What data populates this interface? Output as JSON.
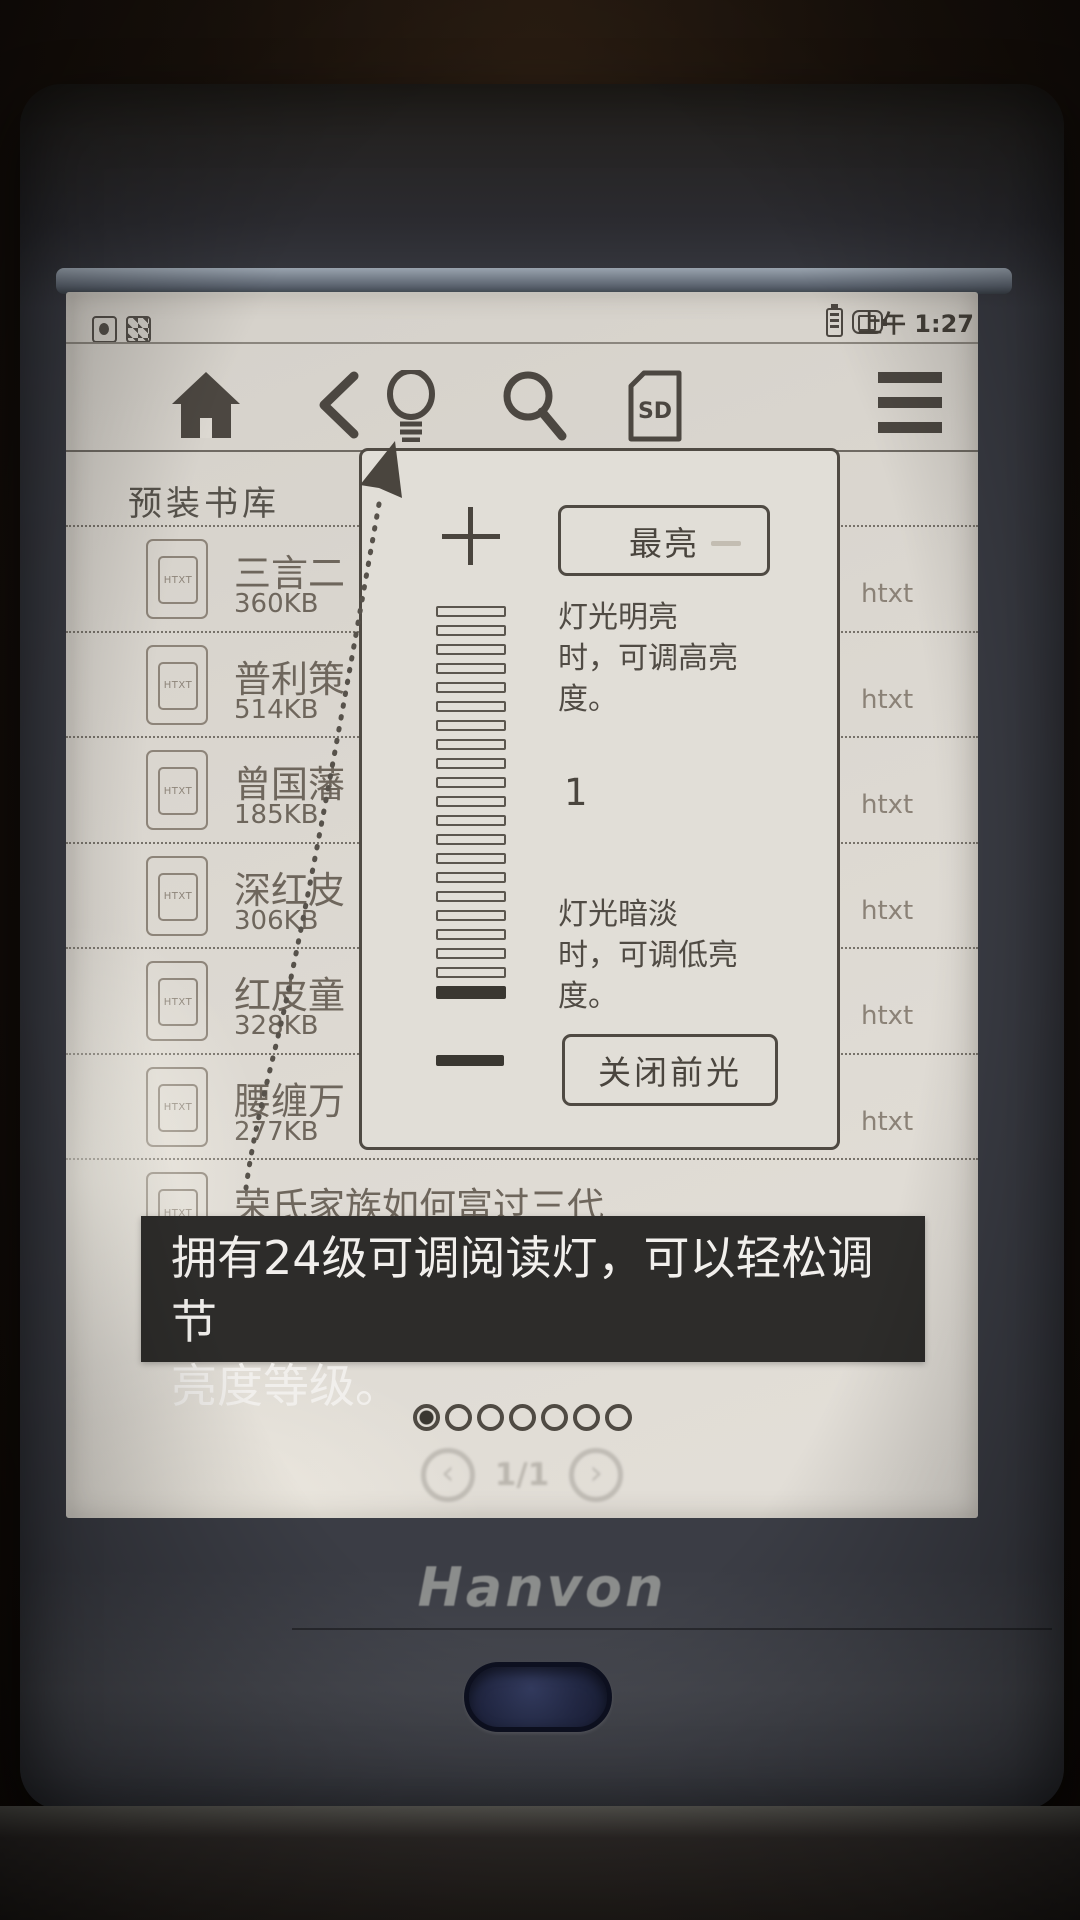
{
  "device": {
    "brand_logo": "Hanvon"
  },
  "status_bar": {
    "time": "上午 1:27",
    "left_icon_names": [
      "storage-icon",
      "sd-card-status-icon"
    ],
    "right_icon_names": [
      "battery-icon",
      "battery-charge-icon"
    ]
  },
  "toolbar": {
    "icon_names": [
      "home-icon",
      "back-icon",
      "frontlight-icon",
      "search-icon",
      "sd-card-icon",
      "menu-icon"
    ],
    "sd_label": "SD"
  },
  "library": {
    "title": "预装书库",
    "book_icon_label": "HTXT",
    "books": [
      {
        "title": "三言二",
        "size": "360KB",
        "format": "htxt"
      },
      {
        "title": "普利策",
        "size": "514KB",
        "format": "htxt"
      },
      {
        "title": "曾国藩",
        "size": "185KB",
        "format": "htxt"
      },
      {
        "title": "深红皮",
        "size": "306KB",
        "format": "htxt"
      },
      {
        "title": "红皮童",
        "size": "328KB",
        "format": "htxt"
      },
      {
        "title": "腰缠万",
        "size": "277KB",
        "format": "htxt"
      },
      {
        "title": "荣氏家族如何富过三代",
        "size": "",
        "format": ""
      }
    ]
  },
  "brightness_popup": {
    "max_button": "最亮",
    "desc_high": "灯光明亮\n时，可调高亮\n度。",
    "current_level": "1",
    "desc_low": "灯光暗淡\n时，可调低亮\n度。",
    "off_button": "关闭前光",
    "slider_levels": 21,
    "active_level_from_bottom": 1,
    "icon_names": [
      "plus-icon",
      "minus-icon",
      "pointer-arrow-icon"
    ]
  },
  "caption_banner": {
    "text": "拥有24级可调阅读灯，可以轻松调节\n亮度等级。"
  },
  "pager": {
    "dots_total": 7,
    "active_dot": 1,
    "page_indicator": "1/1",
    "prev_icon_glyph": "‹",
    "next_icon_glyph": "›"
  },
  "colors": {
    "screen_bg": "#dcd8d1",
    "ink": "#4c4741",
    "faded_ink": "#8d8479",
    "banner_bg": "#2d2c2a",
    "banner_text": "#f1efec",
    "bezel": "#3b3d45",
    "home_button": "#232946"
  }
}
